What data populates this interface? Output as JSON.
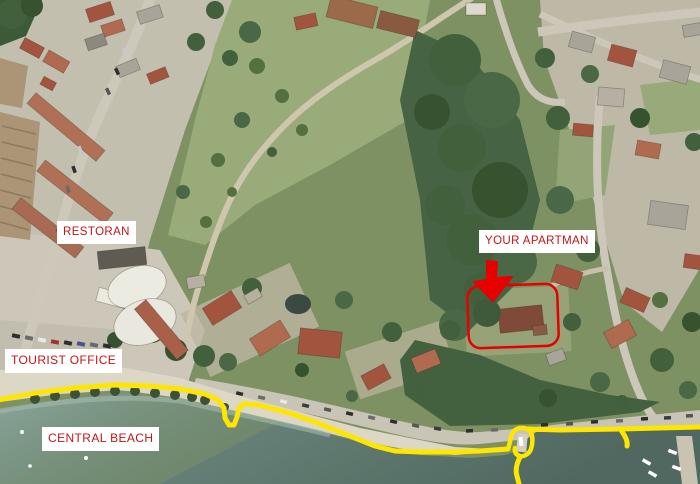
{
  "map": {
    "type": "annotated-satellite-photo",
    "labels": {
      "restoran": "RESTORAN",
      "your_apartman": "YOUR APARTMAN",
      "tourist_office": "TOURIST OFFICE",
      "central_beach": "CENTRAL BEACH"
    },
    "annotations": {
      "arrow": "red arrow pointing at apartment",
      "highlight": "red rounded rectangle around apartment property",
      "route": "yellow line along beach promenade and seawall"
    },
    "colors": {
      "label_text": "#c41414",
      "label_bg": "#ffffff",
      "annotation_red": "#e60000",
      "route_yellow": "#ffe600",
      "sea_light": "#8aa69b",
      "sea_dark": "#50685f",
      "sand": "#ddd8c6",
      "road_gray": "#cdc8ba",
      "tree_green": "#42603c",
      "roof_red": "#a3543e"
    }
  }
}
